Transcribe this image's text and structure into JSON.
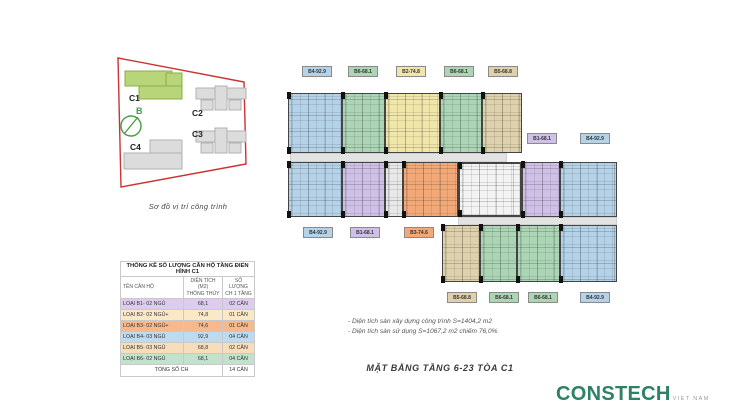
{
  "site_diagram": {
    "caption": "Sơ đồ vị trí công trình",
    "compass_label": "B",
    "building_labels": [
      "C1",
      "C2",
      "C3",
      "C4"
    ],
    "highlight_color": "#b9d579",
    "boundary_color": "#cc3333"
  },
  "table": {
    "title": "THỐNG KÊ SỐ LƯỢNG CĂN HỘ TẦNG ĐIỂN HÌNH C1",
    "col_name": "TÊN CĂN HỘ",
    "col_area_line1": "DIỆN TÍCH (M2)",
    "col_area_line2": "THÔNG THỦY",
    "col_count_line1": "SỐ LƯỢNG",
    "col_count_line2": "CH 1 TẦNG",
    "rows": [
      {
        "name": "LOẠI B1- 02 NGỦ",
        "area": "68,1",
        "count": "02 CĂN",
        "color": "#ddccf0"
      },
      {
        "name": "LOẠI B2- 02 NGỦ+",
        "area": "74,8",
        "count": "01 CĂN",
        "color": "#fae8c6"
      },
      {
        "name": "LOẠI B3- 02 NGỦ+",
        "area": "74,6",
        "count": "01 CĂN",
        "color": "#f6b98d"
      },
      {
        "name": "LOẠI B4- 03 NGỦ",
        "area": "92,9",
        "count": "04 CĂN",
        "color": "#bedaee"
      },
      {
        "name": "LOẠI B5- 03 NGỦ",
        "area": "68,8",
        "count": "02 CĂN",
        "color": "#f7ddba"
      },
      {
        "name": "LOẠI B6- 02 NGỦ",
        "area": "68,1",
        "count": "04 CĂN",
        "color": "#c2e2cb"
      }
    ],
    "total_label": "TỔNG SỐ CH",
    "total_value": "14 CĂN"
  },
  "floor_plan": {
    "unit_colors": {
      "B1": {
        "fill": "#cfc0e8",
        "line": "#8f74b8"
      },
      "B2": {
        "fill": "#f1e6a9",
        "line": "#bfae5a"
      },
      "B3": {
        "fill": "#f2a977",
        "line": "#c57a40"
      },
      "B4": {
        "fill": "#b4d2e8",
        "line": "#6d9cc2"
      },
      "B5": {
        "fill": "#ded1ac",
        "line": "#ab9760"
      },
      "B6": {
        "fill": "#abd5b5",
        "line": "#69a87b"
      },
      "CORE": {
        "fill": "#f3f3f3",
        "line": "#333333"
      },
      "HALL": {
        "fill": "#e8e8e8",
        "line": "#9a9a9a"
      }
    },
    "top_labels": [
      {
        "text": "B4-92.9",
        "type": "B4"
      },
      {
        "text": "B6-68.1",
        "type": "B6"
      },
      {
        "text": "B2-74.8",
        "type": "B2"
      },
      {
        "text": "B6-68.1",
        "type": "B6"
      },
      {
        "text": "B5-68.8",
        "type": "B5"
      }
    ],
    "right_labels": [
      {
        "text": "B1-68.1",
        "type": "B1"
      },
      {
        "text": "B4-92.9",
        "type": "B4"
      }
    ],
    "mid_labels": [
      {
        "text": "B4-92.9",
        "type": "B4"
      },
      {
        "text": "B1-68.1",
        "type": "B1"
      },
      {
        "text": "B3-74.6",
        "type": "B3"
      }
    ],
    "bottom_labels": [
      {
        "text": "B5-68.8",
        "type": "B5"
      },
      {
        "text": "B6-68.1",
        "type": "B6"
      },
      {
        "text": "B6-68.1",
        "type": "B6"
      },
      {
        "text": "B4-92.9",
        "type": "B4"
      }
    ]
  },
  "notes": {
    "line1": "- Diện tích sàn xây dựng công trình S=1404,2 m2",
    "line2": "- Diện tích sàn sử dụng S=1067,2 m2 chiếm 76,0%"
  },
  "caption": "MẶT BẰNG TẦNG 6-23 TÒA C1",
  "logo": {
    "name": "CONSTECH",
    "sub": "VIET NAM",
    "color": "#2d8165"
  }
}
